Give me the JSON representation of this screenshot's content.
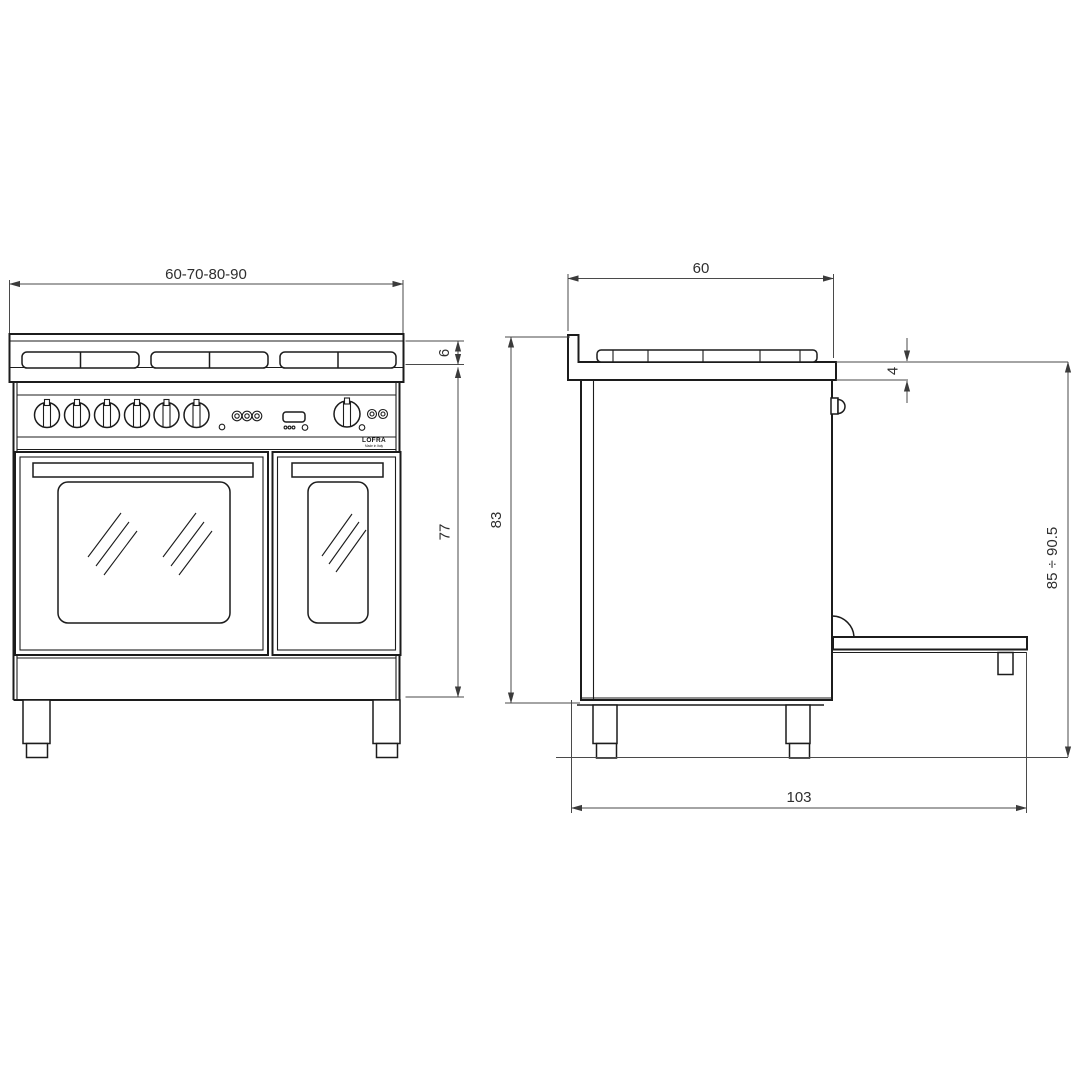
{
  "brand": {
    "name": "LOFRA",
    "tagline": "Made in Italy"
  },
  "views": {
    "front": {
      "dimensions": {
        "width_options": "60-70-80-90",
        "hob_height": "6",
        "body_height": "77"
      }
    },
    "side": {
      "dimensions": {
        "depth": "60",
        "worktop_overhang": "4",
        "height_to_worktop": "83",
        "overall_height_range": "85 ÷ 90.5",
        "depth_door_open": "103"
      }
    }
  },
  "colors": {
    "background": "#ffffff",
    "drawing_line": "#1c1c1c",
    "dimension_line": "#4a4a4a",
    "text": "#2e2e2e"
  }
}
